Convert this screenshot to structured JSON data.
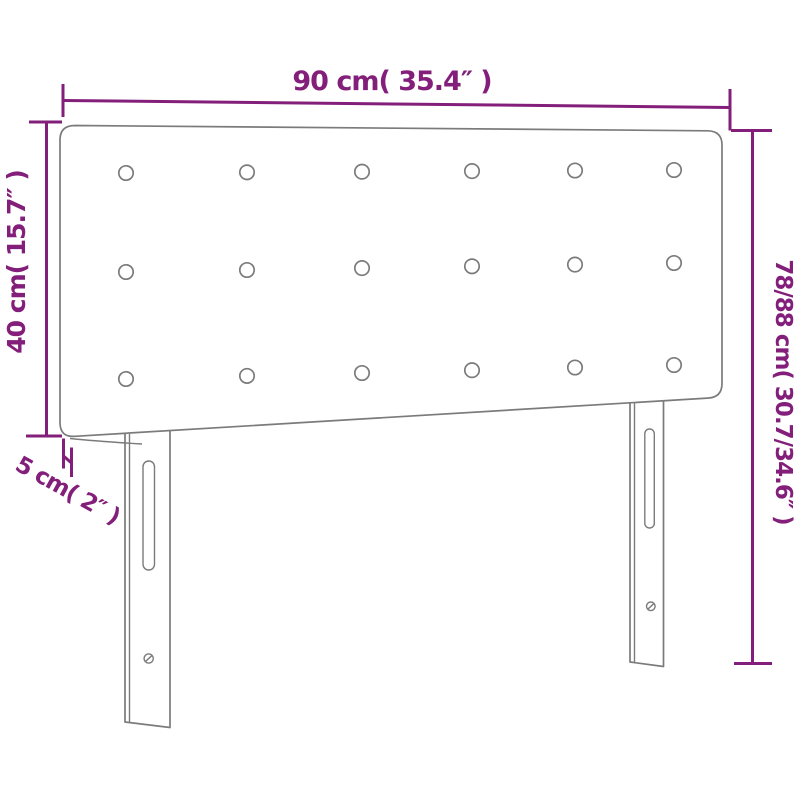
{
  "diagram": {
    "product": "headboard",
    "labels": {
      "width_top": "90 cm( 35.4″ )",
      "height_left": "40 cm( 15.7″ )",
      "height_right": "78/88 cm( 30.7/34.6″ )",
      "thickness": "5 cm( 2″ )"
    },
    "colors": {
      "dimension": "#831f7a",
      "outline": "#7b7b7b",
      "background": "#ffffff"
    },
    "buttons": {
      "rows": 3,
      "cols": 6
    }
  }
}
